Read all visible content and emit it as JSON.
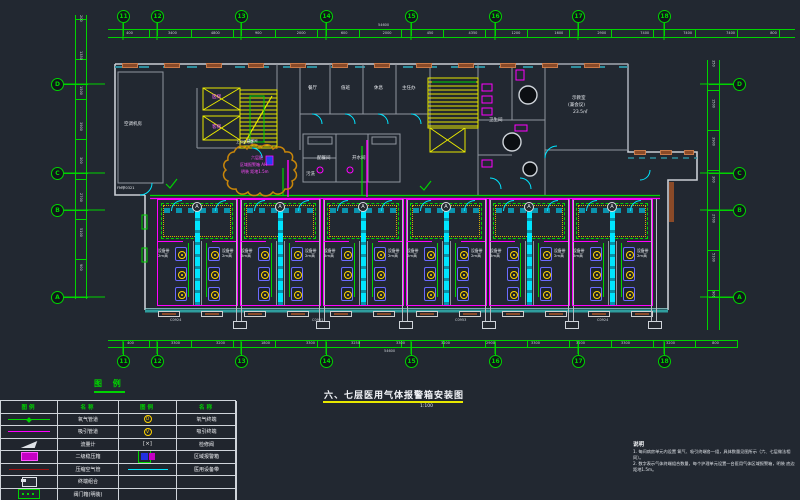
{
  "title": {
    "text": "六、七层医用气体报警箱安装图",
    "scale": "1:100"
  },
  "colors": {
    "background": "#222831",
    "grid_green": "#00d400",
    "pipe_cyan": "#00e5ff",
    "pipe_magenta": "#ff00ff",
    "stair_yellow": "#e8e800",
    "wall_white": "#c9ced4",
    "wall_brown": "#8a4a28",
    "terminal_yellow": "#ffd400",
    "cloud_orange": "#c8860a"
  },
  "grid": {
    "top": [
      {
        "label": "11",
        "style": "left:117px;top:10px"
      },
      {
        "label": "12",
        "style": "left:151px;top:10px"
      },
      {
        "label": "13",
        "style": "left:235px;top:10px"
      },
      {
        "label": "14",
        "style": "left:320px;top:10px"
      },
      {
        "label": "15",
        "style": "left:405px;top:10px"
      },
      {
        "label": "16",
        "style": "left:489px;top:10px"
      },
      {
        "label": "17",
        "style": "left:572px;top:10px"
      },
      {
        "label": "18",
        "style": "left:658px;top:10px"
      }
    ],
    "bottom": [
      {
        "label": "11",
        "style": "left:117px;top:355px"
      },
      {
        "label": "12",
        "style": "left:151px;top:355px"
      },
      {
        "label": "13",
        "style": "left:235px;top:355px"
      },
      {
        "label": "14",
        "style": "left:320px;top:355px"
      },
      {
        "label": "15",
        "style": "left:405px;top:355px"
      },
      {
        "label": "16",
        "style": "left:489px;top:355px"
      },
      {
        "label": "17",
        "style": "left:572px;top:355px"
      },
      {
        "label": "18",
        "style": "left:658px;top:355px"
      }
    ],
    "left": [
      {
        "label": "D",
        "style": "left:51px;top:78px"
      },
      {
        "label": "C",
        "style": "left:51px;top:167px"
      },
      {
        "label": "B",
        "style": "left:51px;top:204px"
      },
      {
        "label": "A",
        "style": "left:51px;top:291px"
      }
    ],
    "right": [
      {
        "label": "D",
        "style": "left:733px;top:78px"
      },
      {
        "label": "C",
        "style": "left:733px;top:167px"
      },
      {
        "label": "B",
        "style": "left:733px;top:204px"
      },
      {
        "label": "A",
        "style": "left:733px;top:291px"
      }
    ]
  },
  "dims": {
    "top": [
      "400",
      "3400",
      "4800",
      "900",
      "2000",
      "600",
      "2000",
      "450",
      "4350",
      "1200",
      "1600",
      "2900",
      "7400",
      "7400",
      "7400",
      "800"
    ],
    "bottom": [
      "400",
      "3300",
      "3200",
      "1800",
      "3300",
      "3250",
      "3300",
      "3200",
      "2900",
      "3300",
      "3200",
      "3300",
      "3200",
      "800"
    ],
    "left": [
      "200",
      "1350",
      "1500",
      "3900",
      "300",
      "2700",
      "5100",
      "900"
    ],
    "right": [
      "350",
      "1500",
      "3900",
      "300",
      "2700",
      "5100",
      "900"
    ],
    "top_total": "54600",
    "bottom_total": "54600"
  },
  "plan": {
    "labels": [
      {
        "t": "空调机房",
        "s": "left:124px;top:122px"
      },
      {
        "t": "FM甲0321",
        "s": "left:117px;top:186px;font-size:3.5px"
      },
      {
        "t": "医梯",
        "s": "left:212px;top:95px;color:#ff6bff"
      },
      {
        "t": "客梯",
        "s": "left:212px;top:125px;color:#ff6bff"
      },
      {
        "t": "楼梯间",
        "s": "left:247px;top:139px;font-size:3.5px"
      },
      {
        "t": "餐厅",
        "s": "left:308px;top:86px"
      },
      {
        "t": "值班",
        "s": "left:341px;top:86px"
      },
      {
        "t": "休息",
        "s": "left:374px;top:86px"
      },
      {
        "t": "主任办",
        "s": "left:402px;top:86px"
      },
      {
        "t": "配餐间",
        "s": "left:317px;top:156px"
      },
      {
        "t": "开水间",
        "s": "left:352px;top:156px"
      },
      {
        "t": "污洗",
        "s": "left:306px;top:172px"
      },
      {
        "t": "卫生间",
        "s": "left:489px;top:118px"
      },
      {
        "t": "示教室",
        "s": "left:572px;top:96px"
      },
      {
        "t": "(兼会议)",
        "s": "left:568px;top:103px"
      },
      {
        "t": "23.5㎡",
        "s": "left:573px;top:110px"
      },
      {
        "t": "上引至七层",
        "s": "left:236px;top:140px;font-size:3.5px"
      },
      {
        "t": "六层配",
        "s": "left:251px;top:155px;color:#ff4bff;font-size:4px"
      },
      {
        "t": "区域报警箱 AH",
        "s": "left:240px;top:162px;color:#ff4bff;font-size:4px"
      },
      {
        "t": "明装 距地1.5m",
        "s": "left:241px;top:169px;color:#ff4bff;font-size:4px"
      },
      {
        "t": "C0924",
        "s": "left:170px;top:318px;font-size:3.5px;color:#cfd4da"
      },
      {
        "t": "C0951",
        "s": "left:312px;top:318px;font-size:3.5px;color:#cfd4da"
      },
      {
        "t": "C0953",
        "s": "left:455px;top:318px;font-size:3.5px;color:#cfd4da"
      },
      {
        "t": "C0924",
        "s": "left:597px;top:318px;font-size:3.5px;color:#cfd4da"
      }
    ],
    "bays": [
      {
        "tag": "A",
        "l1": "设备带",
        "l2": "2m高",
        "style": "left:156px;top:197px"
      },
      {
        "tag": "A",
        "l1": "设备带",
        "l2": "2m高",
        "style": "left:239px;top:197px"
      },
      {
        "tag": "A",
        "l1": "设备带",
        "l2": "2m高",
        "style": "left:322px;top:197px"
      },
      {
        "tag": "A",
        "l1": "设备带",
        "l2": "2m高",
        "style": "left:405px;top:197px"
      },
      {
        "tag": "A",
        "l1": "设备带",
        "l2": "2m高",
        "style": "left:488px;top:197px"
      },
      {
        "tag": "A",
        "l1": "设备带",
        "l2": "2m高",
        "style": "left:571px;top:197px"
      }
    ],
    "top_blocks": [
      {
        "style": "left:122px;top:63px"
      },
      {
        "style": "left:164px;top:63px"
      },
      {
        "style": "left:206px;top:63px"
      },
      {
        "style": "left:248px;top:63px"
      },
      {
        "style": "left:290px;top:63px"
      },
      {
        "style": "left:332px;top:63px"
      },
      {
        "style": "left:374px;top:63px"
      },
      {
        "style": "left:416px;top:63px"
      },
      {
        "style": "left:458px;top:63px"
      },
      {
        "style": "left:500px;top:63px"
      },
      {
        "style": "left:542px;top:63px"
      },
      {
        "style": "left:584px;top:63px"
      },
      {
        "style": "left:634px;top:150px;width:12px"
      },
      {
        "style": "left:660px;top:150px;width:12px"
      },
      {
        "style": "left:684px;top:150px;width:10px"
      }
    ],
    "windows": [
      {
        "style": "left:158px;top:311px"
      },
      {
        "style": "left:201px;top:311px"
      },
      {
        "style": "left:244px;top:311px"
      },
      {
        "style": "left:287px;top:311px"
      },
      {
        "style": "left:330px;top:311px"
      },
      {
        "style": "left:373px;top:311px"
      },
      {
        "style": "left:416px;top:311px"
      },
      {
        "style": "left:459px;top:311px"
      },
      {
        "style": "left:502px;top:311px"
      },
      {
        "style": "left:545px;top:311px"
      },
      {
        "style": "left:588px;top:311px"
      },
      {
        "style": "left:631px;top:311px"
      }
    ]
  },
  "legend": {
    "heading": "图 例",
    "headers": [
      "图例",
      "名称",
      "图例",
      "名称"
    ],
    "rows": [
      {
        "ls": "oxygen-pipe",
        "lg": "",
        "ln": "氧气管道",
        "rs": "oxygen-terminal",
        "rg": "O",
        "rn": "氧气终端"
      },
      {
        "ls": "vacuum-pipe",
        "lg": "",
        "ln": "吸引管道",
        "rs": "suction-terminal",
        "rg": "V",
        "rn": "吸引终端"
      },
      {
        "ls": "flow-meter",
        "lg": "",
        "ln": "流量计",
        "rs": "service-valve",
        "rg": "[×]",
        "rn": "检修阀"
      },
      {
        "ls": "regulator-box",
        "lg": "",
        "ln": "二级稳压箱",
        "rs": "area-alarm-box",
        "rg": "",
        "rn": "区域报警箱"
      },
      {
        "ls": "air-pipe",
        "lg": "",
        "ln": "压缩空气管",
        "rs": "medical-band",
        "rg": "",
        "rn": "医用设备带"
      },
      {
        "ls": "terminal-outlet",
        "lg": "",
        "ln": "终端组合",
        "rs": "none",
        "rg": "",
        "rn": ""
      },
      {
        "ls": "valve-box",
        "lg": "",
        "ln": "阀门箱(明装)",
        "rs": "none",
        "rg": "",
        "rn": ""
      }
    ]
  },
  "notes": {
    "heading": "说明",
    "items": [
      "1. 每间病房单元内设置 氧气、吸引终端各一组，具体数量见图所示（六、七层做法相同）。",
      "2. 数字表示气体终端组合数量，每个护理单元设置一台医用气体区域报警箱，明装 底边距地1.5m。"
    ]
  }
}
